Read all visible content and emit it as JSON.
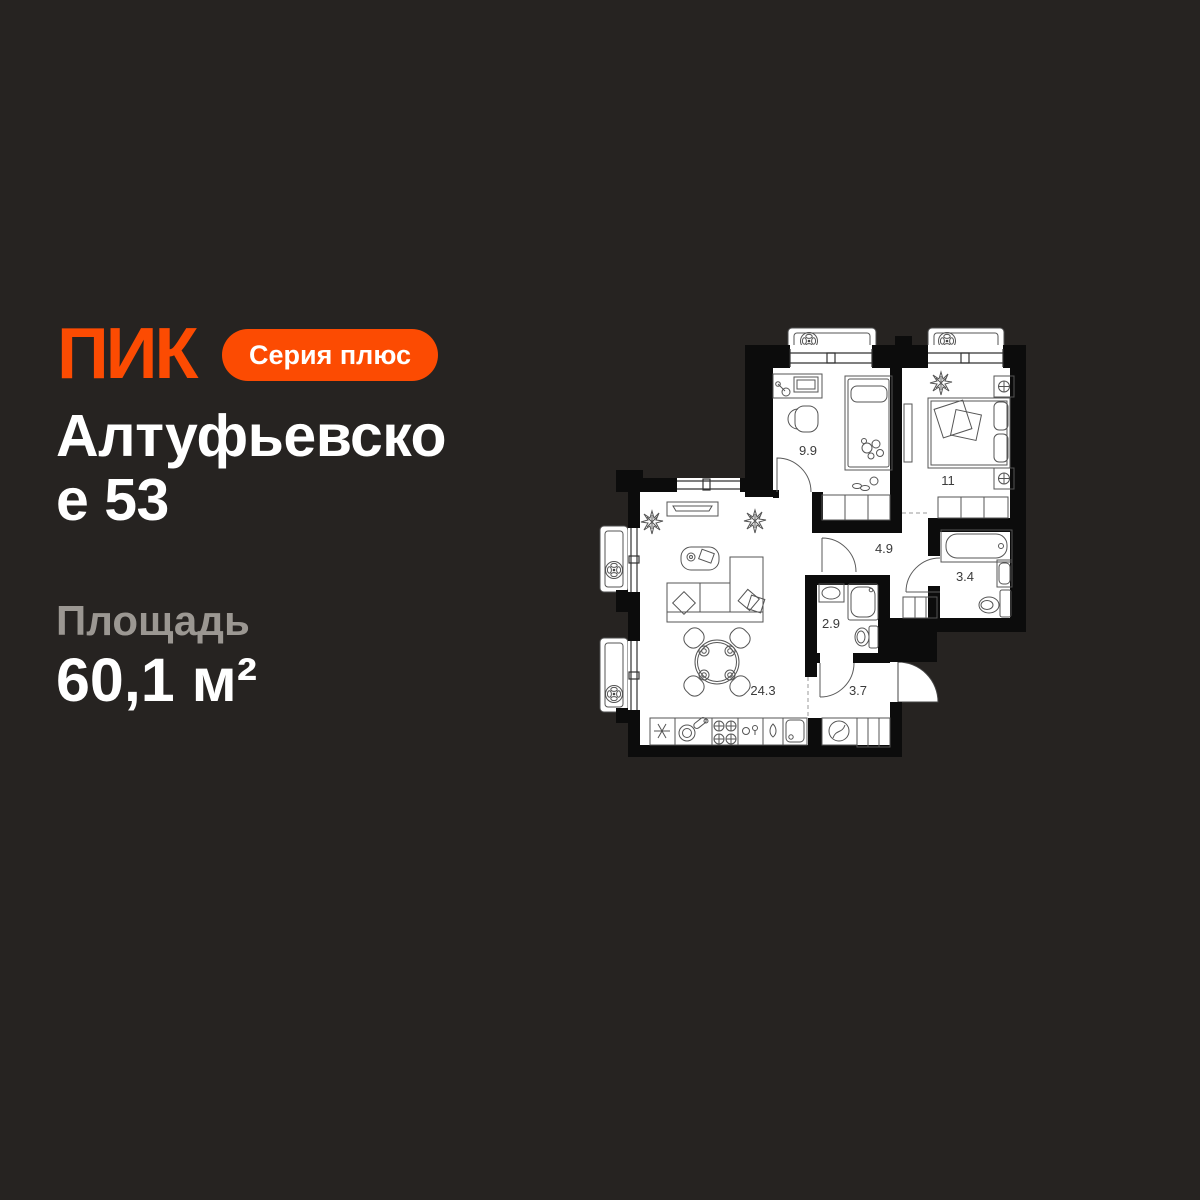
{
  "theme": {
    "background": "#262321",
    "accent": "#FC4B02",
    "text_primary": "#FFFFFF",
    "text_secondary": "#9B9792",
    "plan_floor": "#FFFFFF",
    "plan_walls": "#0C0C0C"
  },
  "header": {
    "logo": "ПИК",
    "badge": "Серия плюс"
  },
  "listing": {
    "title": "Алтуфьевское 53",
    "title_lines": [
      "Алтуфьевско",
      "е 53"
    ],
    "area_label": "Площадь",
    "area_value": "60,1 м²"
  },
  "floor_plan": {
    "total_area": "60,1",
    "rooms": [
      {
        "name": "bedroom-1",
        "area": "9.9"
      },
      {
        "name": "bedroom-2",
        "area": "11"
      },
      {
        "name": "hallway",
        "area": "4.9"
      },
      {
        "name": "bathroom",
        "area": "3.4"
      },
      {
        "name": "shower-room",
        "area": "2.9"
      },
      {
        "name": "living-kitchen",
        "area": "24.3"
      },
      {
        "name": "entry-hall",
        "area": "3.7"
      }
    ]
  }
}
